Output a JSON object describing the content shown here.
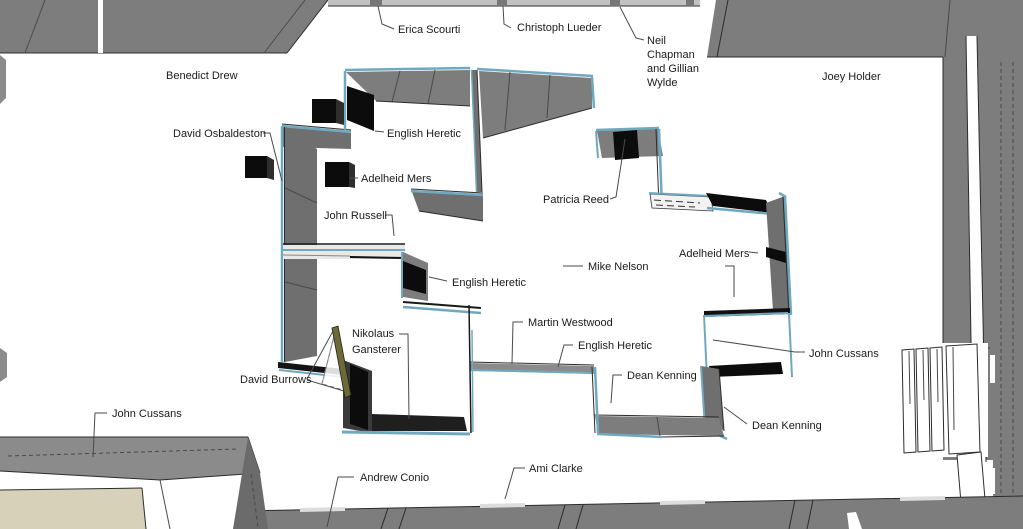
{
  "diagram": {
    "title": "exhibition-floor-plan-3d",
    "colors": {
      "wall_gray": "#7d7d7d",
      "wall_mid": "#6f6f6f",
      "wall_light": "#8b8b8b",
      "edge_teal": "#6fa9bf",
      "artwork_black": "#0c0c0c",
      "floor_beige": "#d8d1ba",
      "outline_ink": "#2c2c2c",
      "leader_gray": "#4a4a4a",
      "text_black": "#1a1a1a"
    },
    "labels": {
      "erica_scourti": "Erica Scourti",
      "christoph_lueder": "Christoph Lueder",
      "neil_chapman_gillian_wylde": {
        "lines": [
          "Neil",
          "Chapman",
          "and Gillian",
          "Wylde"
        ]
      },
      "benedict_drew": "Benedict Drew",
      "joey_holder": "Joey Holder",
      "david_osbaldeston": "David Osbaldeston",
      "english_heretic_top": "English Heretic",
      "adelheid_mers_left": "Adelheid Mers",
      "john_russell": "John Russell",
      "patricia_reed": "Patricia Reed",
      "mike_nelson": "Mike Nelson",
      "adelheid_mers_right": "Adelheid Mers",
      "english_heretic_center": "English Heretic",
      "martin_westwood": "Martin Westwood",
      "english_heretic_bottom": "English Heretic",
      "dean_kenning_left": "Dean Kenning",
      "john_cussans_right": "John Cussans",
      "nikolaus_gansterer": {
        "lines": [
          "Nikolaus",
          "Gansterer"
        ]
      },
      "david_burrows": "David Burrows",
      "dean_kenning_right": "Dean Kenning",
      "john_cussans_left": "John Cussans",
      "andrew_conio": "Andrew Conio",
      "ami_clarke": "Ami Clarke"
    }
  }
}
